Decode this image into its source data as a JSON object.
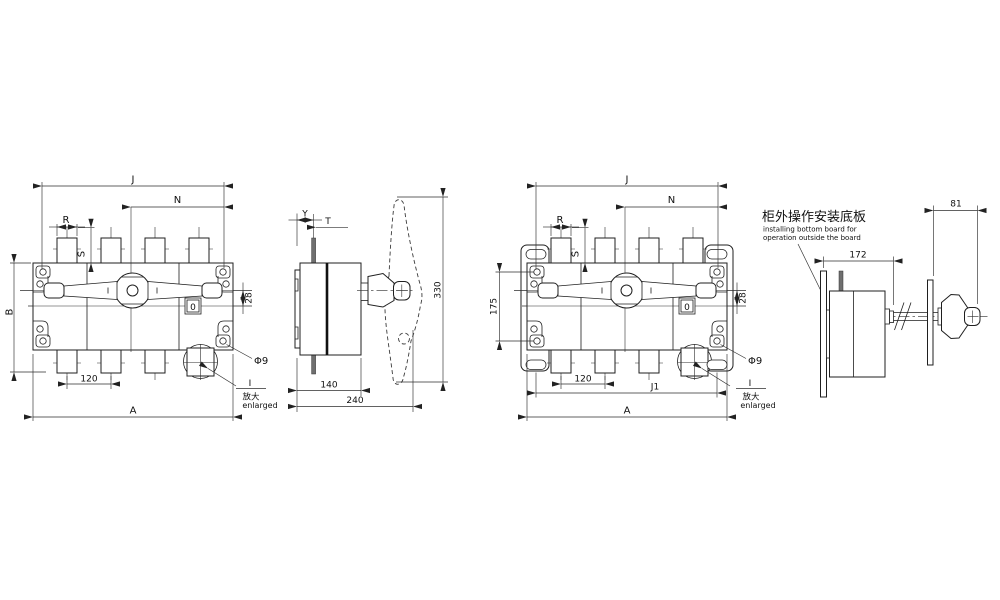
{
  "drawing": {
    "front_left": {
      "dim_j": "J",
      "dim_n": "N",
      "dim_r": "R",
      "dim_s": "S",
      "dim_b": "B",
      "dim_a": "A",
      "dim_pitch": "120",
      "dim_offset": "28",
      "dim_hole": "Φ9",
      "indicator": "0",
      "detail_mark": "I",
      "detail_label_zh": "放大",
      "detail_label_en": "enlarged"
    },
    "side_left": {
      "dim_y": "Y",
      "dim_t": "T",
      "dim_swing": "330",
      "dim_depth": "140",
      "dim_total_depth": "240"
    },
    "front_right": {
      "dim_j": "J",
      "dim_n": "N",
      "dim_r": "R",
      "dim_s": "S",
      "dim_mount": "175",
      "dim_j1": "J1",
      "dim_a": "A",
      "dim_pitch": "120",
      "dim_offset": "28",
      "dim_hole": "Φ9",
      "indicator": "0",
      "detail_mark": "I",
      "detail_label_zh": "放大",
      "detail_label_en": "enlarged"
    },
    "side_right": {
      "dim_panel": "81",
      "dim_shaft": "172",
      "note_zh": "柜外操作安装底板",
      "note_en_1": "installing bottom board for",
      "note_en_2": "operation outside the board"
    },
    "colors": {
      "background": "#ffffff",
      "object_line": "#1f1f1f",
      "dim_line": "#2e2e2e",
      "dark_fill": "#6f6f6f"
    }
  }
}
